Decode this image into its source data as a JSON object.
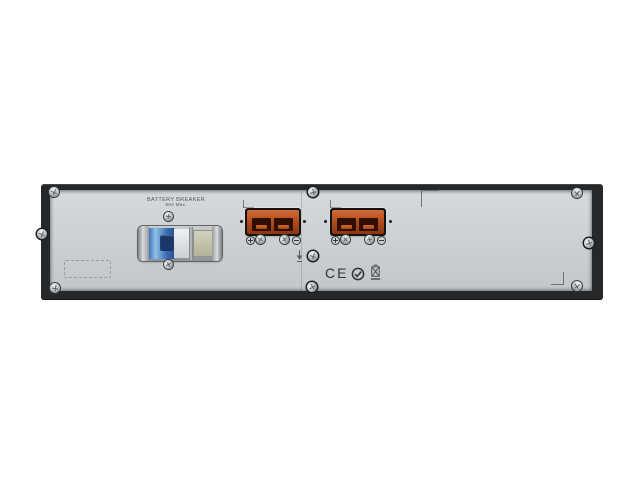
{
  "image": {
    "description": "Rear panel of a dark 2U rack-mount UPS external battery pack on a white background",
    "background_color": "#ffffff"
  },
  "panel": {
    "breaker": {
      "label": "BATTERY BREAKER",
      "rating": "50A Max.",
      "type": "dc-circuit-breaker-switch"
    },
    "connectors": {
      "count": 2,
      "names": [
        "battery-connector-1",
        "battery-connector-2"
      ],
      "style": "orange Anderson-type DC battery connector in black bezel",
      "polarity_left_symbol": "+",
      "polarity_right_symbol": "−"
    },
    "symbols": {
      "ground": "earth-ground-arrow",
      "certifications": [
        "CE",
        "c-tick-circle",
        "weee-crossed-bin"
      ],
      "ce_text": "CE"
    },
    "hardware": {
      "screw_icon": "philips-screw",
      "label_placeholder": "dashed outline rectangle (empty label area)"
    },
    "colors": {
      "chassis_frame": "#25282a",
      "panel_gray": "#cdd1d3",
      "connector_orange": "#b44d1d",
      "connector_slot": "#310e02",
      "breaker_blue": "#3b6db4",
      "breaker_navy": "#1b3769",
      "breaker_beige": "#c6c5ac",
      "mark_gray": "#6e7375"
    }
  }
}
